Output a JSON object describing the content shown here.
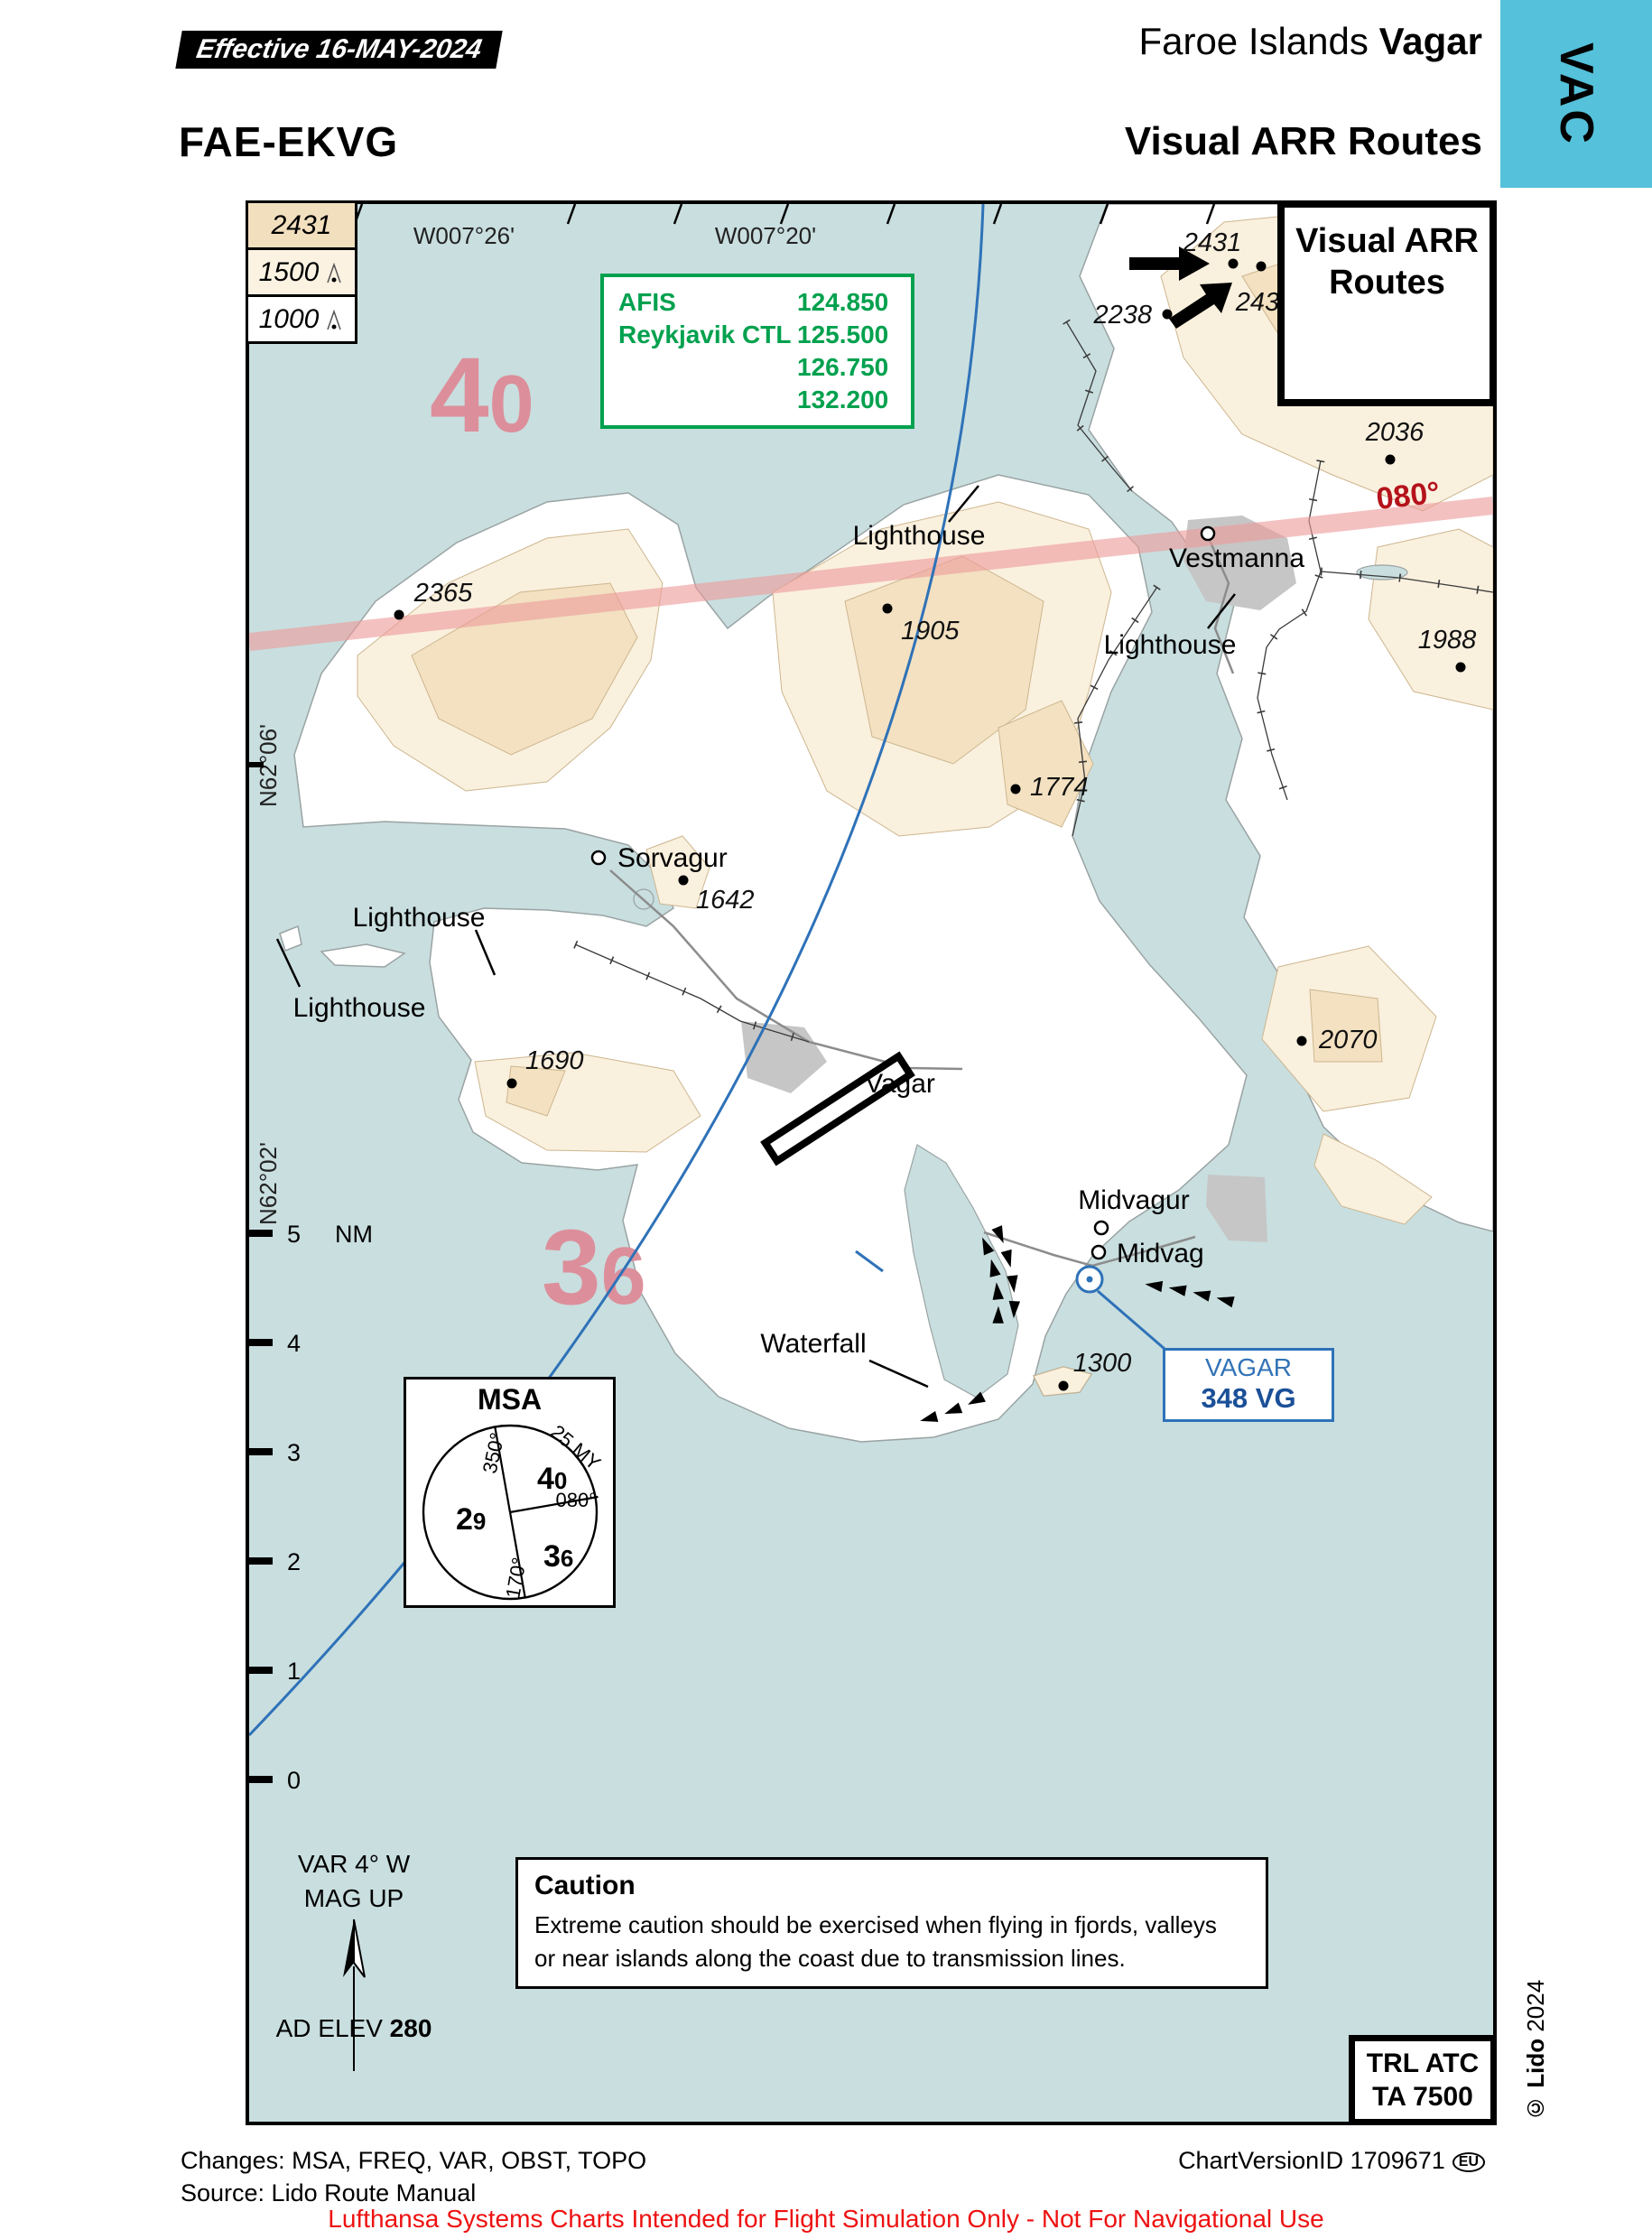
{
  "header": {
    "effective": "Effective  16-MAY-2024",
    "region": "Faroe Islands ",
    "city": "Vagar",
    "code": "FAE-EKVG",
    "title": "Visual ARR Routes",
    "tab": "VAC"
  },
  "map": {
    "title_box_line1": "Visual ARR",
    "title_box_line2": "Routes",
    "legend": {
      "rows": [
        {
          "value": "2431"
        },
        {
          "value": "1500"
        },
        {
          "value": "1000"
        }
      ]
    },
    "freq": {
      "afis_label": "AFIS",
      "afis_value": "124.850",
      "ctl_label": "Reykjavik CTL",
      "ctl_values": [
        "125.500",
        "126.750",
        "132.200"
      ]
    },
    "meridians": [
      "W007°26'",
      "W007°20'"
    ],
    "parallels": [
      "N62°06'",
      "N62°02'"
    ],
    "bearing_label": "080°",
    "msa_big": {
      "a1": "4",
      "a2": "0",
      "b1": "3",
      "b2": "6"
    },
    "spots": [
      {
        "v": "2431"
      },
      {
        "v": "2431"
      },
      {
        "v": "2238"
      },
      {
        "v": "2036"
      },
      {
        "v": "2365"
      },
      {
        "v": "1905"
      },
      {
        "v": "1988"
      },
      {
        "v": "1774"
      },
      {
        "v": "1642"
      },
      {
        "v": "1690"
      },
      {
        "v": "2070"
      },
      {
        "v": "1300"
      }
    ],
    "places": {
      "vestmanna": "Vestmanna",
      "sorvagur": "Sorvagur",
      "midvagur": "Midvagur",
      "midvag": "Midvag"
    },
    "labels": {
      "lighthouse": "Lighthouse",
      "waterfall": "Waterfall",
      "airport": "Vagar"
    },
    "scale": {
      "unit": "NM",
      "ticks": [
        "5",
        "4",
        "3",
        "2",
        "1",
        "0"
      ]
    },
    "vor": {
      "name": "VAGAR",
      "ident": "348 VG",
      "morse": "···− −−·"
    },
    "msa": {
      "title": "MSA",
      "range_ref": "25 MY",
      "bearings": {
        "b350": "350°",
        "b080": "080°",
        "b170": "170°"
      },
      "sectors": {
        "ne": {
          "d1": "4",
          "d2": "0"
        },
        "w": {
          "d1": "2",
          "d2": "9"
        },
        "se": {
          "d1": "3",
          "d2": "6"
        }
      }
    },
    "variation": {
      "line1": "VAR 4° W",
      "line2": "MAG UP"
    },
    "ad_elev": {
      "label": "AD ELEV ",
      "value": "280"
    },
    "caution": {
      "title": "Caution",
      "lines": [
        "Extreme caution should be exercised when flying in fjords, valleys",
        "or near islands along the coast due to transmission lines."
      ]
    },
    "trl": {
      "line1": "TRL ATC",
      "line2": "TA 7500"
    },
    "route_arrows_5": "►  ►  ►  ►  ►",
    "route_arrows_4": "►  ►  ►  ►",
    "route_arrows_3": "►  ►  ►",
    "copyright_bold": "© Lido ",
    "copyright_year": "2024"
  },
  "footer": {
    "changes": "Changes: MSA, FREQ, VAR, OBST, TOPO",
    "source": "Source: Lido Route Manual",
    "version": "ChartVersionID 1709671",
    "region_badge": "EU",
    "disclaimer": "Lufthansa Systems Charts Intended for Flight Simulation Only - Not For Navigational Use"
  }
}
